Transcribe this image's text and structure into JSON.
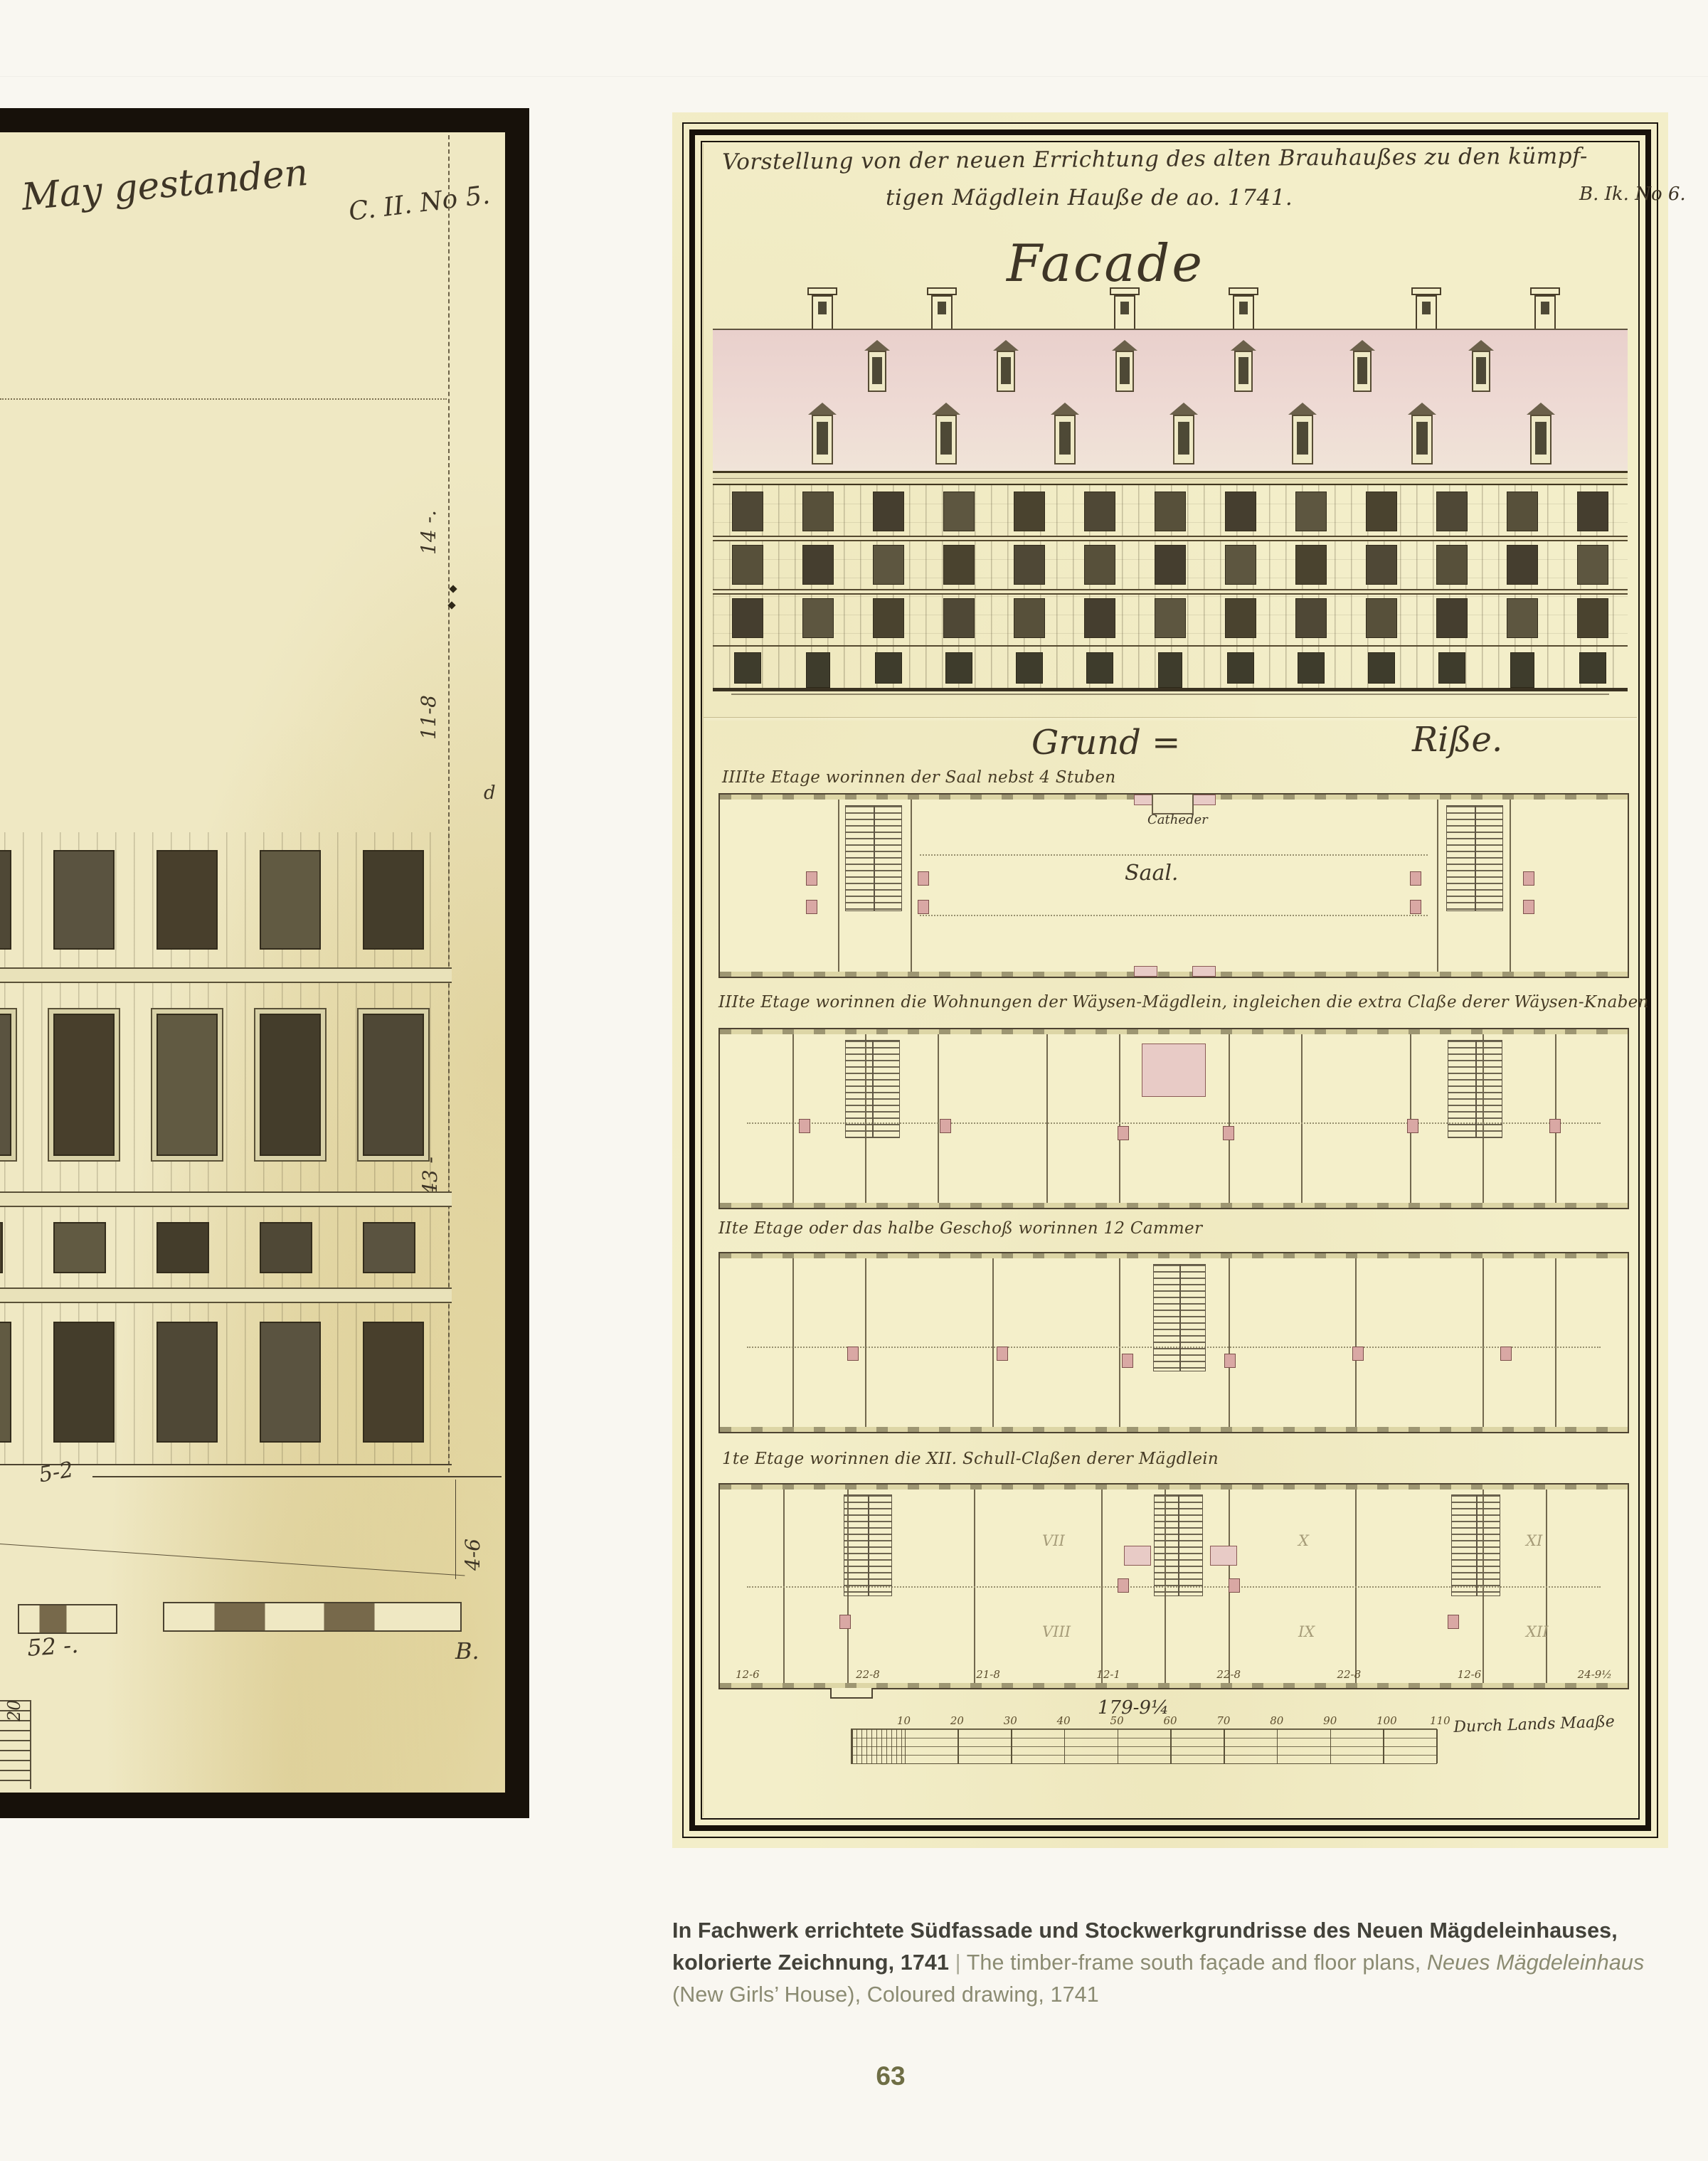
{
  "page": {
    "number": "63"
  },
  "colors": {
    "page_background": "#f9f7f1",
    "paper_left": "#efe8c3",
    "paper_right": "#f3eec9",
    "ink": "#3e3526",
    "frame_black": "#17110a",
    "roof_pink": "#ecd4cf",
    "window_dark": "#4e4936",
    "stove_pink": "#d9a8a4",
    "caption_text": "#43423a",
    "caption_translation": "#8b8b72",
    "page_number_color": "#6f6e45"
  },
  "left_drawing": {
    "inscription": "May gestanden",
    "archive_no": "C. II. No 5.",
    "dim_top": "14 -.",
    "dim_mid": "11-8",
    "dim_low": "43 -",
    "marker_d": "d",
    "dim_width": "5-2",
    "dim_height": "4-6",
    "dim_total": "52 -.",
    "marker_b": "B.",
    "scale_number": "20"
  },
  "right_drawing": {
    "title_line1": "Vorstellung von der neuen Errichtung des alten Brauhaußes zu den kümpf-",
    "title_line2": "tigen Mägdlein Hauße de ao. 1741.",
    "title_ref": "B. Ik. No 6.",
    "facade_heading": "Facade",
    "plans_heading_left": "Grund =",
    "plans_heading_right": "Riße.",
    "floors": [
      {
        "label": "IIIIte Etage worinnen der Saal nebst 4 Stuben",
        "rooms": {
          "catheder": "Catheder",
          "saal": "Saal."
        }
      },
      {
        "label": "IIIte Etage worinnen die Wohnungen der Wäysen-Mägdlein, ingleichen die extra Claße derer Wäysen-Knaben"
      },
      {
        "label": "IIte Etage oder das halbe Geschoß worinnen 12 Cammer"
      },
      {
        "label": "1te Etage worinnen die XII. Schull-Claßen derer Mägdlein",
        "room_numerals": [
          "VII",
          "X",
          "XI",
          "VIII",
          "IX",
          "XII"
        ]
      }
    ],
    "bottom_dims": [
      "12-6",
      "22-8",
      "21-8",
      "12-1",
      "22-8",
      "22-8",
      "12-6",
      "24-9½"
    ],
    "total_dimension": "179-9¼",
    "scale": {
      "ticks": [
        "10",
        "20",
        "30",
        "40",
        "50",
        "60",
        "70",
        "80",
        "90",
        "100",
        "110"
      ],
      "label": "Durch Lands Maaße"
    }
  },
  "caption": {
    "german": "In Fachwerk errichtete Südfassade und Stockwerkgrundrisse des Neuen Mägdeleinhauses, kolorierte Zeichnung, 1741",
    "separator": " | ",
    "english_prefix": "The timber-frame south façade and floor plans, ",
    "english_italic": "Neues Mägdeleinhaus",
    "english_suffix": " (New Girls’ House), Coloured drawing, 1741"
  }
}
